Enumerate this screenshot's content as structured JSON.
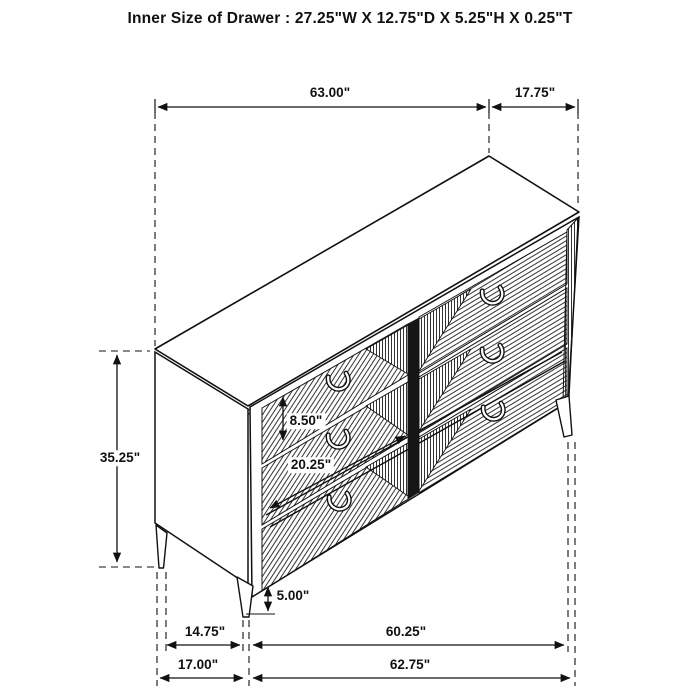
{
  "title": "Inner Size of Drawer : 27.25\"W X 12.75\"D X 5.25\"H X 0.25\"T",
  "figure": {
    "description": "Isometric black-and-white line drawing of a six-drawer dresser with chevron-fluted drawer fronts, curved pull handles and tapered legs, annotated with dimension arrows",
    "line_color": "#111111",
    "background_color": "#ffffff"
  },
  "dimensions": {
    "top_width": "63.00\"",
    "top_depth": "17.75\"",
    "overall_height": "35.25\"",
    "drawer_front_height": "8.50\"",
    "drawer_opening_width": "20.25\"",
    "leg_height": "5.00\"",
    "leg_span_depth": "14.75\"",
    "leg_span_width": "60.25\"",
    "base_depth": "17.00\"",
    "base_width": "62.75\""
  }
}
